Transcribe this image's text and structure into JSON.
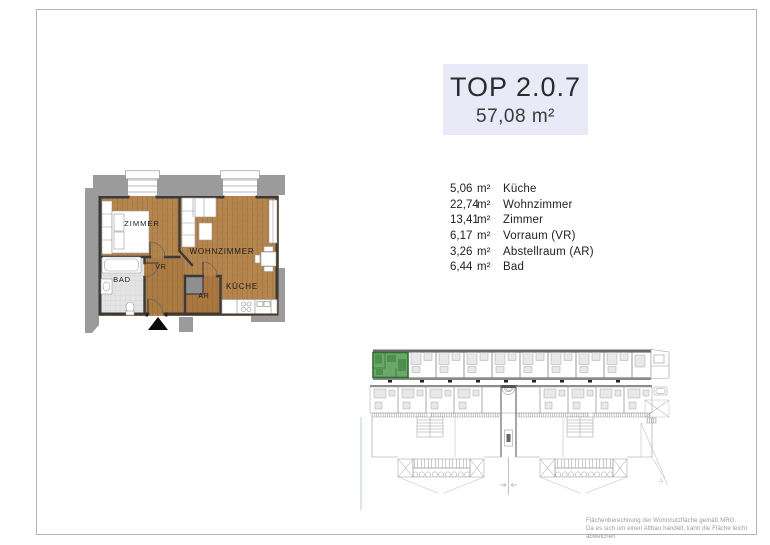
{
  "header": {
    "unit_title": "TOP 2.0.7",
    "total_area": "57,08 m²"
  },
  "room_list": [
    {
      "area": "5,06",
      "unit": "m²",
      "name": "Küche"
    },
    {
      "area": "22,74",
      "unit": "m²",
      "name": "Wohnzimmer"
    },
    {
      "area": "13,41",
      "unit": "m²",
      "name": "Zimmer"
    },
    {
      "area": "6,17",
      "unit": "m²",
      "name": "Vorraum (VR)"
    },
    {
      "area": "3,26",
      "unit": "m²",
      "name": "Abstellraum (AR)"
    },
    {
      "area": "6,44",
      "unit": "m²",
      "name": "Bad"
    }
  ],
  "floor_plan": {
    "labels": {
      "zimmer": "ZIMMER",
      "wohnzimmer": "WOHNZIMMER",
      "vr": "VR",
      "bad": "BAD",
      "ar": "AR",
      "kueche": "KÜCHE"
    }
  },
  "footnote": {
    "line1": "Flächenberechnung der Wohnnutzfläche gemäß MRG.",
    "line2": "Da es sich um einen Altbau handelt, kann die Fläche leicht abweichen"
  },
  "colors": {
    "title_bg": "#e9e9f7",
    "wood": "#b5854e",
    "wall": "#3a3a3a",
    "surround": "#9b9b9b",
    "tile": "#e4e4e4",
    "highlight_green": "#69a869",
    "highlight_green_dark": "#4d8f4d",
    "highlight_green_wall": "#2f6e2f"
  }
}
